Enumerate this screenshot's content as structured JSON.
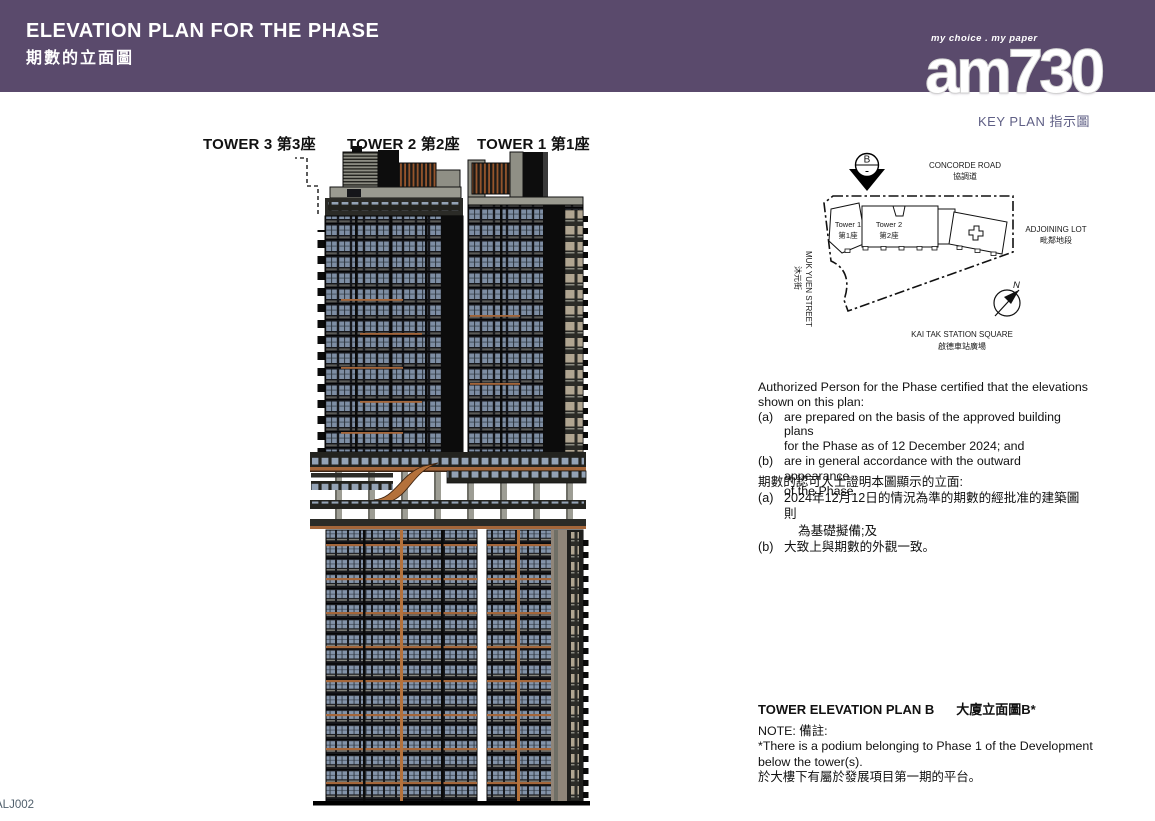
{
  "header": {
    "title_en": "ELEVATION PLAN FOR THE PHASE",
    "title_zh": "期數的立面圖"
  },
  "logo": {
    "tagline": "my choice . my paper",
    "brand": "am730"
  },
  "key_plan": {
    "title": "KEY PLAN 指示圖",
    "section_marker": "B",
    "north": "N",
    "concorde_en": "CONCORDE ROAD",
    "concorde_zh": "協調道",
    "adjoining_en": "ADJOINING LOT",
    "adjoining_zh": "毗鄰地段",
    "muk_yuen_en": "MUK YUEN STREET",
    "muk_yuen_zh": "沐元街",
    "kai_tak_en": "KAI TAK STATION SQUARE",
    "kai_tak_zh": "啟德車站廣場",
    "tower1_en": "Tower 1",
    "tower1_zh": "第1座",
    "tower2_en": "Tower 2",
    "tower2_zh": "第2座"
  },
  "elevation_labels": {
    "tower3": "TOWER 3 第3座",
    "tower2": "TOWER 2 第2座",
    "tower1": "TOWER 1 第1座"
  },
  "cert_en": {
    "intro1": "Authorized Person for the Phase certified that the elevations",
    "intro2": "shown on this plan:",
    "a_marker": "(a)",
    "a_line1": "are prepared on the basis of the approved building plans",
    "a_line2": "for the Phase as of 12 December 2024; and",
    "b_marker": "(b)",
    "b_line1": "are in general accordance with the outward appearance",
    "b_line2": "of the Phase."
  },
  "cert_zh": {
    "intro": "期數的認可人士證明本圖顯示的立面:",
    "a_marker": "(a)",
    "a_line1": "2024年12月12日的情況為準的期數的經批准的建築圖則",
    "a_line2": "為基礎擬備;及",
    "b_marker": "(b)",
    "b_line1": "大致上與期數的外觀一致。"
  },
  "plan_title": {
    "en": "TOWER ELEVATION PLAN B",
    "zh": "大廈立面圖B*"
  },
  "note": {
    "label": "NOTE: 備註:",
    "en1": "*There is a podium belonging to Phase 1 of the Development",
    "en2": "below the tower(s).",
    "zh": "於大樓下有屬於發展項目第一期的平台。"
  },
  "footer_code": "ALJ002",
  "colors": {
    "header_bg": "#5a4a6c",
    "keyplan_label": "#5f5f85",
    "copper_accent": "#a4663a",
    "glass": "#7e8ea4"
  }
}
